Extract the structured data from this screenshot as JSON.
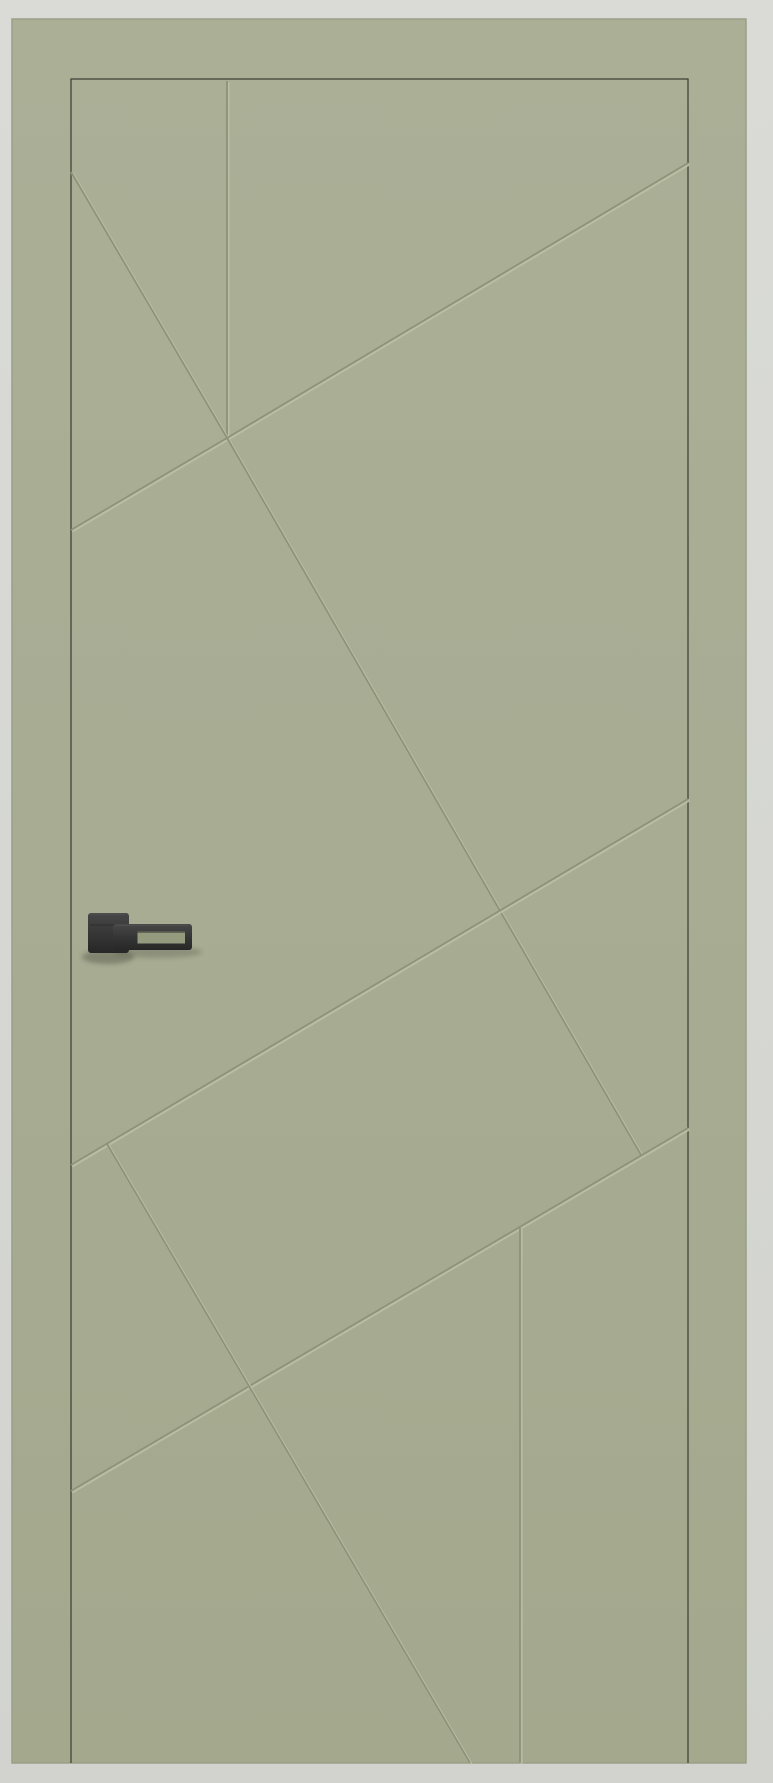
{
  "scene": {
    "description": "Product photo of a closed sage-green interior door with engraved geometric groove pattern and a black square-rose lever handle, on a light gray background",
    "object": "interior-door"
  },
  "canvas": {
    "width": 773,
    "height": 1783
  },
  "colors": {
    "background_top": "#dadbd7",
    "background_bottom": "#d2d3cf",
    "door_top": "#abaf96",
    "door_mid": "#a8ac93",
    "door_bottom": "#a4a88d",
    "door_edge": "#99a085",
    "leaf_gap_line": "#3c4034",
    "groove_dark": "#8d927a",
    "groove_light": "#bbbfa3",
    "handle_top": "#474747",
    "handle_dark": "#343434",
    "handle_darker": "#272727",
    "handle_cutout": "#949a7e",
    "handle_cutout_shadow": "#54584a",
    "handle_highlight": "#5f5f5f",
    "shadow": "#2d3026"
  },
  "door": {
    "outer": {
      "x": 12,
      "y": 19,
      "width": 734,
      "height": 1744
    },
    "leaf_gap": {
      "left": 71,
      "top": 79,
      "right": 688,
      "bottom": 1763
    }
  },
  "grooves": [
    {
      "name": "groove-vertical-top",
      "x1": 227,
      "y1": 81,
      "x2": 227,
      "y2": 438
    },
    {
      "name": "groove-steep-upper-left",
      "x1": 71,
      "y1": 172,
      "x2": 227,
      "y2": 438
    },
    {
      "name": "groove-shallow-left",
      "x1": 71,
      "y1": 530,
      "x2": 227,
      "y2": 438
    },
    {
      "name": "groove-shallow-top-right",
      "x1": 227,
      "y1": 438,
      "x2": 688,
      "y2": 163
    },
    {
      "name": "groove-steep-center",
      "x1": 227,
      "y1": 438,
      "x2": 641,
      "y2": 1155
    },
    {
      "name": "groove-band-upper",
      "x1": 71,
      "y1": 1165,
      "x2": 688,
      "y2": 799
    },
    {
      "name": "groove-band-lower",
      "x1": 71,
      "y1": 1491,
      "x2": 688,
      "y2": 1128
    },
    {
      "name": "groove-steep-lower-left",
      "x1": 107,
      "y1": 1144,
      "x2": 470,
      "y2": 1763
    },
    {
      "name": "groove-vertical-bottom",
      "x1": 520,
      "y1": 1228,
      "x2": 520,
      "y2": 1763
    }
  ],
  "groove_style": {
    "dark_width": 1.8,
    "light_width": 3,
    "light_offset": 1.1
  },
  "handle": {
    "rose": {
      "x": 88,
      "y": 913,
      "width": 41,
      "height": 40,
      "radius": 3
    },
    "lever": {
      "x": 113,
      "y": 924,
      "width": 79,
      "height": 26,
      "radius": 3
    },
    "cutout": {
      "x": 137.5,
      "y": 931.5,
      "width": 47.5,
      "height": 12
    },
    "seam_y": 925,
    "shadow_rose": {
      "cx": 108,
      "cy": 957,
      "rx": 26,
      "ry": 7
    },
    "shadow_lever": {
      "cx": 158,
      "cy": 952,
      "rx": 44,
      "ry": 6
    }
  },
  "floor_line_y": 1763
}
